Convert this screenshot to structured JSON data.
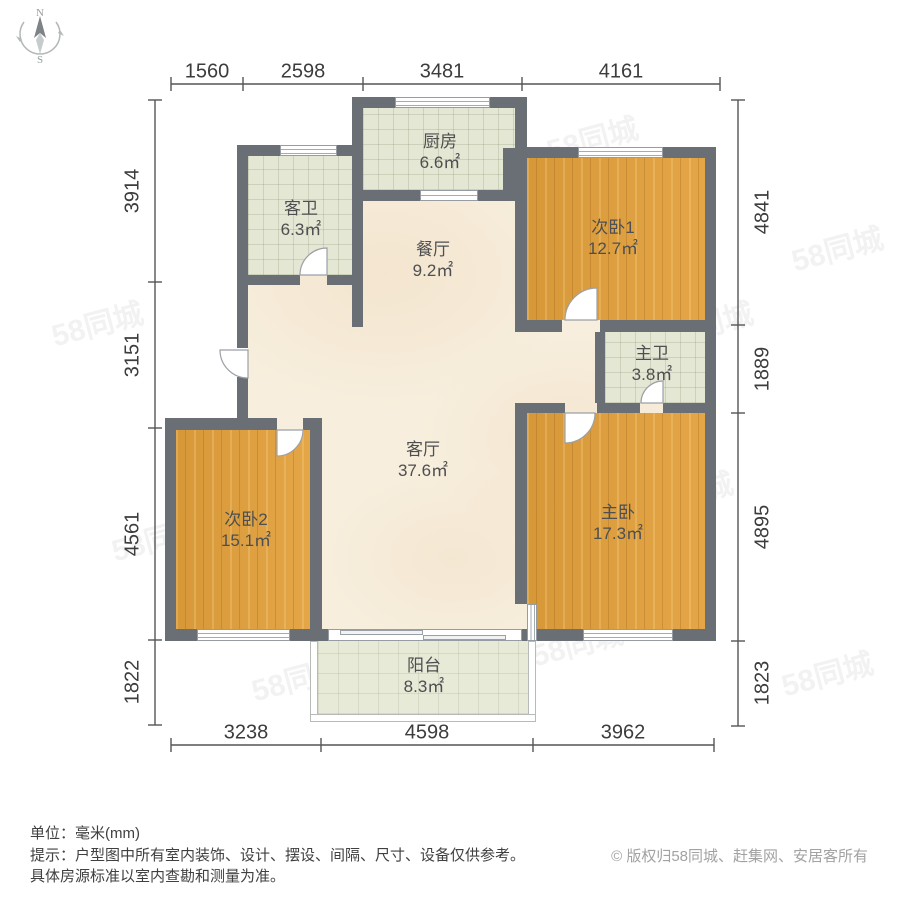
{
  "compass": {
    "north_label": "N",
    "south_label": "S"
  },
  "dimensions": {
    "top": [
      "1560",
      "2598",
      "3481",
      "4161"
    ],
    "left": [
      "3914",
      "3151",
      "4561",
      "1822"
    ],
    "right": [
      "4841",
      "1889",
      "4895",
      "1823"
    ],
    "bottom": [
      "3238",
      "4598",
      "3962"
    ]
  },
  "rooms": {
    "kitchen": {
      "name": "厨房",
      "area": "6.6㎡"
    },
    "guest_bath": {
      "name": "客卫",
      "area": "6.3㎡"
    },
    "bedroom1": {
      "name": "次卧1",
      "area": "12.7㎡"
    },
    "dining": {
      "name": "餐厅",
      "area": "9.2㎡"
    },
    "master_bath": {
      "name": "主卫",
      "area": "3.8㎡"
    },
    "living": {
      "name": "客厅",
      "area": "37.6㎡"
    },
    "bedroom2": {
      "name": "次卧2",
      "area": "15.1㎡"
    },
    "master_bedroom": {
      "name": "主卧",
      "area": "17.3㎡"
    },
    "balcony": {
      "name": "阳台",
      "area": "8.3㎡"
    }
  },
  "footer": {
    "unit_line": "单位：毫米(mm)",
    "tip_line1": "提示：户型图中所有室内装饰、设计、摆设、间隔、尺寸、设备仅供参考。",
    "tip_line2": "具体房源标准以室内查勘和测量为准。",
    "copyright": "© 版权归58同城、赶集网、安居客所有"
  },
  "watermark": {
    "text": "58同城"
  },
  "colors": {
    "wall": "#6a6f76",
    "wood_floor": "#e2a03b",
    "bath_tile": "#e4e7d3",
    "marble_floor": "#f7eedd",
    "balcony_tile": "#e8ead8",
    "dimension_text": "#3c3c3c",
    "copyright_text": "#a2a2a2"
  }
}
